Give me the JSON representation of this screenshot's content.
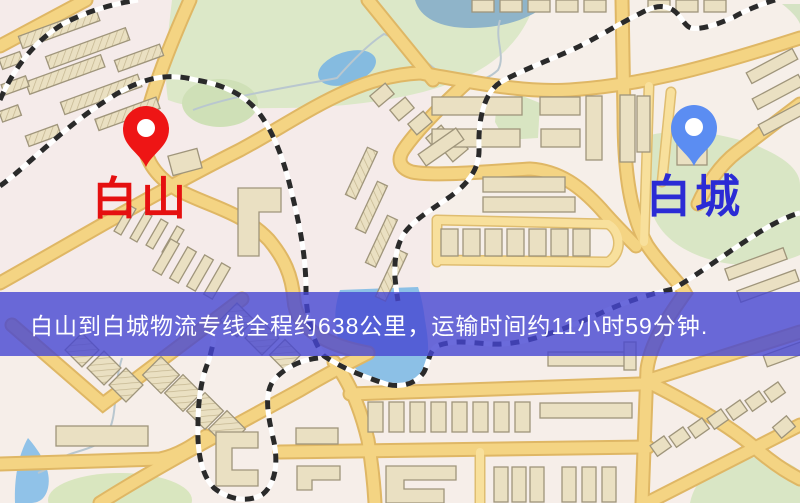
{
  "map": {
    "origin": {
      "name": "白山",
      "pin_color": "#ee1515",
      "label_color": "#e51010",
      "icon": "map-pin-icon"
    },
    "destination": {
      "name": "白城",
      "pin_color": "#5b8df2",
      "label_color": "#2b2bd5",
      "icon": "map-pin-icon"
    }
  },
  "banner": {
    "text": "白山到白城物流专线全程约638公里，运输时间约11小时59分钟.",
    "background": "#4646d2cc",
    "text_color": "#ffffff"
  },
  "route": {
    "distance_km": 638,
    "duration_hours": 11,
    "duration_minutes": 59
  }
}
